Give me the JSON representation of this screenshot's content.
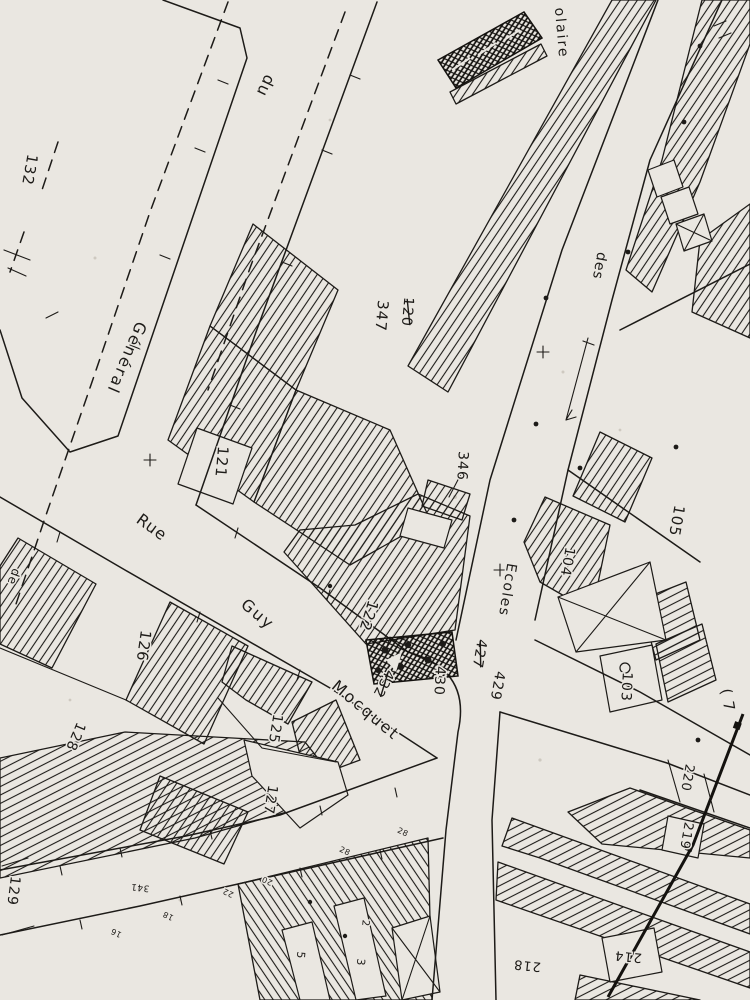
{
  "map": {
    "palette": {
      "paper": "#eae7e1",
      "ink": "#1d1b18"
    },
    "labels": [
      {
        "name": "parcel-132",
        "text": "132",
        "x": 30,
        "y": 170,
        "rot": 100,
        "size": 15,
        "ls": 1
      },
      {
        "name": "street-du",
        "text": "du",
        "x": 266,
        "y": 86,
        "rot": 115,
        "size": 16,
        "ls": 1
      },
      {
        "name": "street-olaire",
        "text": "olaire",
        "x": 562,
        "y": 33,
        "rot": 85,
        "size": 14,
        "ls": 2
      },
      {
        "name": "street-des",
        "text": "des",
        "x": 600,
        "y": 266,
        "rot": 100,
        "size": 14,
        "ls": 1
      },
      {
        "name": "street-ecoles",
        "text": "Ecoles",
        "x": 508,
        "y": 590,
        "rot": 99,
        "size": 14,
        "ls": 1.5
      },
      {
        "name": "street-general",
        "text": "Général",
        "x": 127,
        "y": 358,
        "rot": 113,
        "size": 16,
        "ls": 2
      },
      {
        "name": "street-rue",
        "text": "Rue",
        "x": 152,
        "y": 527,
        "rot": 36,
        "size": 16,
        "ls": 1
      },
      {
        "name": "street-guy",
        "text": "Guy",
        "x": 258,
        "y": 614,
        "rot": 40,
        "size": 16,
        "ls": 2
      },
      {
        "name": "street-mocquet",
        "text": "Mocquet",
        "x": 366,
        "y": 710,
        "rot": 40,
        "size": 16,
        "ls": 2
      },
      {
        "name": "street-de",
        "text": "de",
        "x": 14,
        "y": 577,
        "rot": 110,
        "size": 12,
        "ls": 1
      },
      {
        "name": "parcel-347",
        "text": "347",
        "x": 382,
        "y": 316,
        "rot": 95,
        "size": 15,
        "ls": 1
      },
      {
        "name": "parcel-120-struck",
        "text": "120",
        "x": 408,
        "y": 312,
        "rot": 95,
        "size": 14,
        "ls": 1,
        "strike": true
      },
      {
        "name": "parcel-121",
        "text": "121",
        "x": 222,
        "y": 462,
        "rot": 95,
        "size": 15,
        "ls": 1
      },
      {
        "name": "parcel-122",
        "text": "122",
        "x": 369,
        "y": 616,
        "rot": 107,
        "size": 15,
        "ls": 1
      },
      {
        "name": "parcel-346",
        "text": "346",
        "x": 463,
        "y": 466,
        "rot": 93,
        "size": 14,
        "ls": 1
      },
      {
        "name": "parcel-427-struck",
        "text": "427",
        "x": 480,
        "y": 654,
        "rot": 100,
        "size": 14,
        "ls": 1,
        "strike": true
      },
      {
        "name": "parcel-429",
        "text": "429",
        "x": 498,
        "y": 686,
        "rot": 100,
        "size": 14,
        "ls": 1
      },
      {
        "name": "parcel-432-struck",
        "text": "432",
        "x": 384,
        "y": 684,
        "rot": 118,
        "size": 14,
        "ls": 1,
        "strike": true
      },
      {
        "name": "parcel-430",
        "text": "430",
        "x": 440,
        "y": 681,
        "rot": 93,
        "size": 14,
        "ls": 1
      },
      {
        "name": "parcel-105",
        "text": "105",
        "x": 677,
        "y": 521,
        "rot": 100,
        "size": 15,
        "ls": 1
      },
      {
        "name": "parcel-104",
        "text": "104",
        "x": 568,
        "y": 562,
        "rot": 100,
        "size": 14,
        "ls": 1
      },
      {
        "name": "parcel-103",
        "text": "103",
        "x": 627,
        "y": 687,
        "rot": 93,
        "size": 14,
        "ls": 1
      },
      {
        "name": "parcel-220",
        "text": "220",
        "x": 688,
        "y": 778,
        "rot": 100,
        "size": 13,
        "ls": 1
      },
      {
        "name": "parcel-219",
        "text": "219",
        "x": 687,
        "y": 836,
        "rot": 100,
        "size": 13,
        "ls": 1
      },
      {
        "name": "parcel-218",
        "text": "218",
        "x": 527,
        "y": 966,
        "rot": 186,
        "size": 13,
        "ls": 1
      },
      {
        "name": "parcel-214",
        "text": "214",
        "x": 628,
        "y": 957,
        "rot": 186,
        "size": 13,
        "ls": 1
      },
      {
        "name": "parcel-126",
        "text": "126",
        "x": 144,
        "y": 646,
        "rot": 98,
        "size": 15,
        "ls": 1
      },
      {
        "name": "parcel-125",
        "text": "125",
        "x": 276,
        "y": 729,
        "rot": 99,
        "size": 14,
        "ls": 1
      },
      {
        "name": "parcel-127",
        "text": "127",
        "x": 271,
        "y": 800,
        "rot": 99,
        "size": 14,
        "ls": 1
      },
      {
        "name": "parcel-128",
        "text": "128",
        "x": 76,
        "y": 737,
        "rot": 113,
        "size": 14,
        "ls": 1
      },
      {
        "name": "parcel-129",
        "text": "129",
        "x": 14,
        "y": 891,
        "rot": 97,
        "size": 14,
        "ls": 1
      },
      {
        "name": "house-341",
        "text": "341",
        "x": 140,
        "y": 888,
        "rot": 186,
        "size": 9,
        "ls": 0.5
      },
      {
        "name": "house-22",
        "text": "22",
        "x": 228,
        "y": 893,
        "rot": 205,
        "size": 8,
        "ls": 0.5
      },
      {
        "name": "house-20",
        "text": "20",
        "x": 267,
        "y": 881,
        "rot": 205,
        "size": 8,
        "ls": 0.5
      },
      {
        "name": "house-18",
        "text": "18",
        "x": 168,
        "y": 916,
        "rot": 205,
        "size": 8,
        "ls": 0.5
      },
      {
        "name": "house-16",
        "text": "16",
        "x": 116,
        "y": 933,
        "rot": 205,
        "size": 8,
        "ls": 0.5
      },
      {
        "name": "plot-5",
        "text": "5",
        "x": 301,
        "y": 955,
        "rot": 95,
        "size": 11,
        "ls": 0
      },
      {
        "name": "plot-3",
        "text": "3",
        "x": 361,
        "y": 962,
        "rot": 95,
        "size": 11,
        "ls": 0
      },
      {
        "name": "plot-2",
        "text": "2",
        "x": 366,
        "y": 923,
        "rot": 95,
        "size": 10,
        "ls": 0
      },
      {
        "name": "house-28a",
        "text": "28",
        "x": 403,
        "y": 832,
        "rot": 25,
        "size": 8,
        "ls": 0.5
      },
      {
        "name": "house-28b",
        "text": "28",
        "x": 345,
        "y": 851,
        "rot": 25,
        "size": 8,
        "ls": 0.5
      },
      {
        "name": "edge-paren-7",
        "text": "( 7",
        "x": 728,
        "y": 700,
        "rot": 80,
        "size": 15,
        "ls": 1
      }
    ]
  }
}
